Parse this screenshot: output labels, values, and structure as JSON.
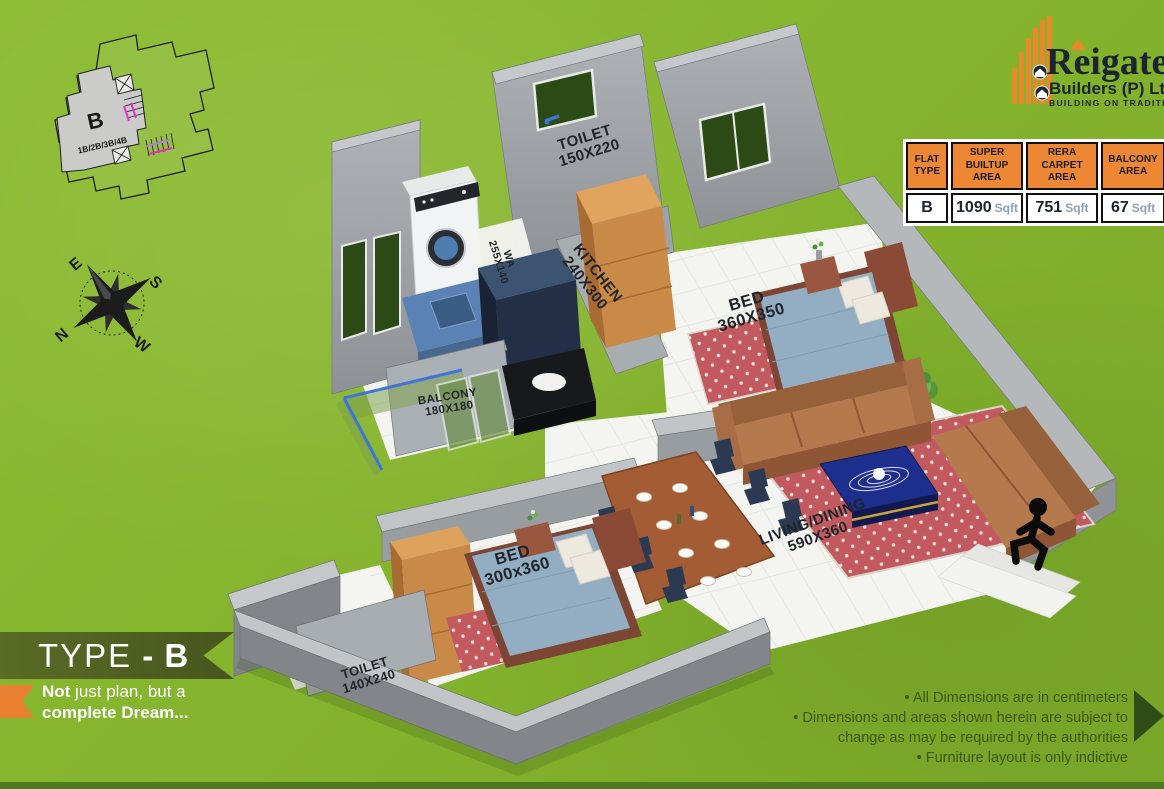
{
  "site_inset": {
    "unit_label": "B",
    "unit_types": "1B/2B/3B/4B"
  },
  "compass": {
    "n": "N",
    "e": "E",
    "s": "S",
    "w": "W"
  },
  "logo": {
    "brand": "Reigate",
    "subtitle": "Builders (P) Ltd",
    "tagline": "BUILDING ON TRADITION"
  },
  "area_table": {
    "headers": [
      "FLAT TYPE",
      "SUPER BUILTUP AREA",
      "RERA CARPET AREA",
      "BALCONY AREA"
    ],
    "row": {
      "flat_type": "B",
      "super_builtup_value": "1090",
      "rera_carpet_value": "751",
      "balcony_value": "67",
      "unit": "Sqft"
    }
  },
  "rooms": {
    "toilet_top": {
      "name": "TOILET",
      "dim": "150X220"
    },
    "kitchen": {
      "name": "KITCHEN",
      "dim": "240X300"
    },
    "work_area": {
      "name": "WA",
      "dim": "255X140"
    },
    "bed_top": {
      "name": "BED",
      "dim": "360X350"
    },
    "balcony": {
      "name": "BALCONY",
      "dim": "180X180"
    },
    "bed_bottom": {
      "name": "BED",
      "dim": "300x360"
    },
    "toilet_bottom": {
      "name": "TOILET",
      "dim": "140X240"
    },
    "living_dining": {
      "name": "LIVING/DINING",
      "dim": "590X360"
    }
  },
  "type_banner": {
    "prefix": "TYPE",
    "suffix": "- B"
  },
  "tagline": {
    "bold1": "Not",
    "rest1": " just plan, but a",
    "line2": "complete Dream..."
  },
  "notes": [
    "• All Dimensions are in centimeters",
    "• Dimensions and areas shown herein are subject to",
    "change as may be required by the authorities",
    "• Furniture layout is only indictive"
  ],
  "colors": {
    "grass": "#84B32D",
    "accent_orange": "#ED8733",
    "banner_green": "#51621F",
    "note_green": "#3E5614",
    "wall_gray": "#9BA0A5",
    "carpet_red": "#C2595F",
    "sofa_brown": "#B5794E",
    "navy": "#2B3A52",
    "logo_navy": "#1B2531"
  }
}
